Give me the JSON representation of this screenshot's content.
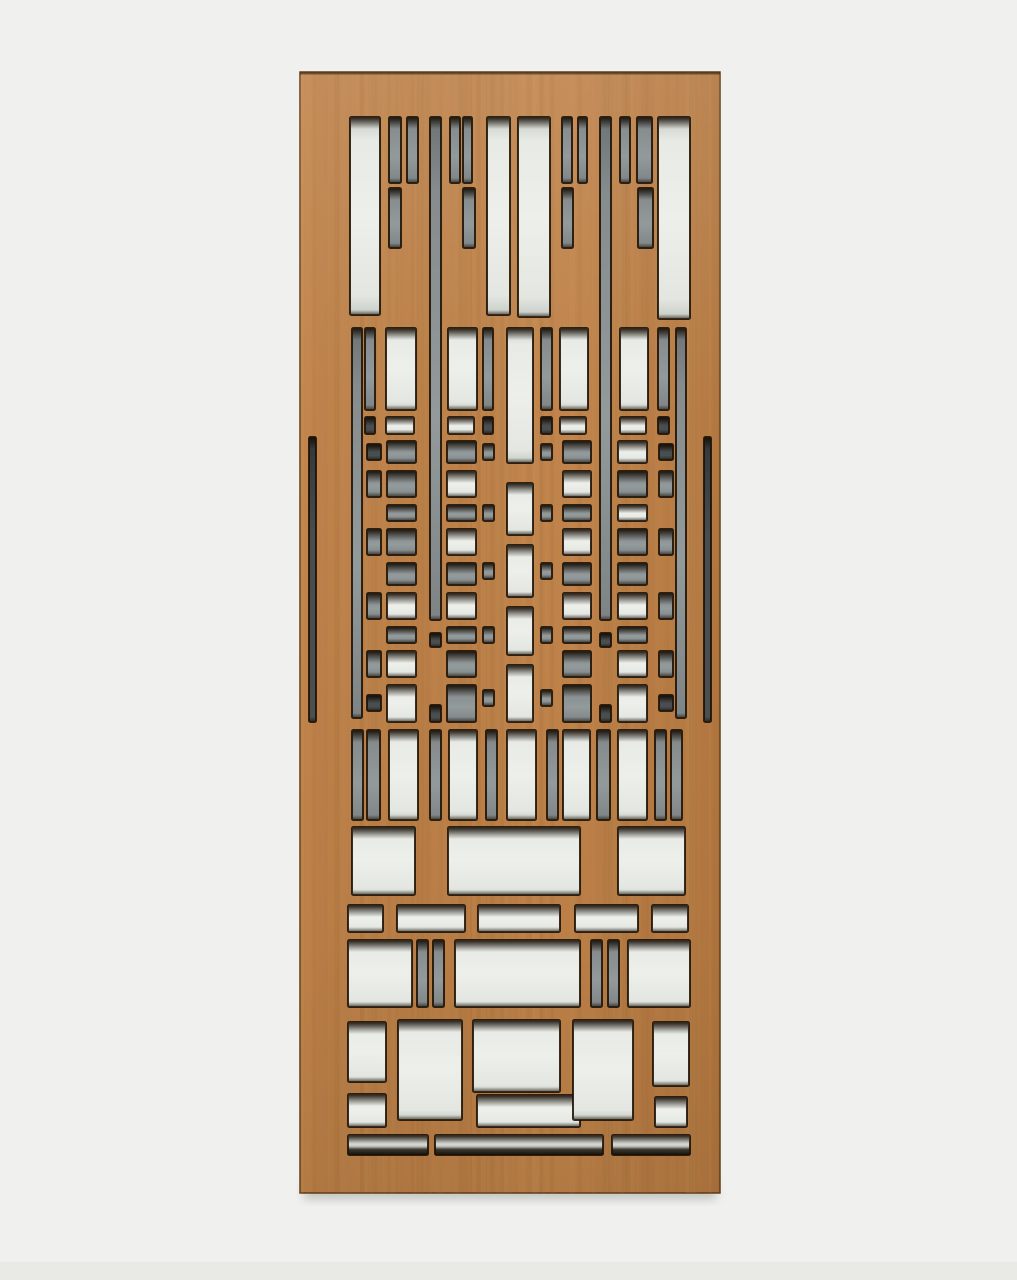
{
  "image": {
    "width": 1017,
    "height": 1280,
    "background": "#f0f1ee",
    "subject": "laser-cut wood fretwork panel, Frank Lloyd Wright style, with frosted backing"
  },
  "panel": {
    "x": 300,
    "y": 72,
    "width": 420,
    "height": 1121,
    "wood_base": "#bc7f46",
    "wood_mid": "#c08349",
    "wood_light": "#d4a168",
    "wood_dark": "#8f5c2d",
    "edge_color": "#5e3c1c",
    "top_edge_color": "#3a2410",
    "drop_shadow": "#9a9a95"
  },
  "cutout_colors": {
    "white": "#edefeb",
    "white_edge": "#c7ccc5",
    "gray": "#939a9b",
    "gray_edge": "#6e7475",
    "dark": "#4a4f50",
    "darker": "#33373a",
    "outline": "#1d1104",
    "inner_shadow": "#140c04",
    "strip_shadow": "#141109"
  },
  "cutouts": [
    [
      350,
      117,
      30,
      198,
      "w"
    ],
    [
      487,
      117,
      23,
      198,
      "w"
    ],
    [
      518,
      117,
      32,
      200,
      "w"
    ],
    [
      658,
      117,
      32,
      202,
      "w"
    ],
    [
      430,
      117,
      11,
      503,
      "g"
    ],
    [
      600,
      117,
      11,
      503,
      "g"
    ],
    [
      389,
      117,
      12,
      66,
      "g"
    ],
    [
      407,
      117,
      11,
      66,
      "g"
    ],
    [
      450,
      117,
      10,
      66,
      "g"
    ],
    [
      463,
      117,
      9,
      66,
      "g"
    ],
    [
      562,
      117,
      10,
      66,
      "g"
    ],
    [
      578,
      117,
      9,
      66,
      "g"
    ],
    [
      620,
      117,
      10,
      66,
      "g"
    ],
    [
      637,
      117,
      15,
      66,
      "g"
    ],
    [
      389,
      188,
      12,
      60,
      "g"
    ],
    [
      463,
      188,
      12,
      60,
      "g"
    ],
    [
      562,
      188,
      11,
      60,
      "g"
    ],
    [
      638,
      188,
      15,
      60,
      "g"
    ],
    [
      352,
      328,
      10,
      390,
      "g"
    ],
    [
      676,
      328,
      10,
      390,
      "g"
    ],
    [
      365,
      328,
      10,
      82,
      "g"
    ],
    [
      483,
      328,
      10,
      82,
      "g"
    ],
    [
      541,
      328,
      11,
      82,
      "g"
    ],
    [
      658,
      328,
      11,
      82,
      "g"
    ],
    [
      386,
      328,
      30,
      82,
      "w"
    ],
    [
      448,
      328,
      29,
      82,
      "w"
    ],
    [
      560,
      328,
      28,
      82,
      "w"
    ],
    [
      620,
      328,
      28,
      82,
      "w"
    ],
    [
      507,
      328,
      26,
      135,
      "w"
    ],
    [
      365,
      417,
      10,
      17,
      "d"
    ],
    [
      386,
      417,
      28,
      17,
      "w"
    ],
    [
      448,
      417,
      26,
      17,
      "w"
    ],
    [
      483,
      417,
      10,
      17,
      "d"
    ],
    [
      541,
      417,
      11,
      17,
      "d"
    ],
    [
      560,
      417,
      26,
      17,
      "w"
    ],
    [
      620,
      417,
      26,
      17,
      "w"
    ],
    [
      658,
      417,
      11,
      17,
      "d"
    ],
    [
      309,
      437,
      7,
      285,
      "d"
    ],
    [
      704,
      437,
      7,
      285,
      "d"
    ],
    [
      507,
      483,
      26,
      52,
      "w"
    ],
    [
      507,
      545,
      26,
      52,
      "w"
    ],
    [
      507,
      607,
      26,
      48,
      "w"
    ],
    [
      507,
      665,
      26,
      57,
      "w"
    ],
    [
      387,
      441,
      29,
      22,
      "g"
    ],
    [
      447,
      441,
      29,
      22,
      "g"
    ],
    [
      563,
      441,
      28,
      22,
      "g"
    ],
    [
      618,
      441,
      29,
      22,
      "w"
    ],
    [
      367,
      444,
      14,
      16,
      "d"
    ],
    [
      483,
      444,
      11,
      16,
      "g"
    ],
    [
      541,
      444,
      11,
      16,
      "g"
    ],
    [
      659,
      444,
      14,
      16,
      "d"
    ],
    [
      367,
      471,
      14,
      26,
      "g"
    ],
    [
      387,
      471,
      29,
      26,
      "g"
    ],
    [
      447,
      471,
      29,
      26,
      "w"
    ],
    [
      563,
      471,
      28,
      26,
      "w"
    ],
    [
      618,
      471,
      29,
      26,
      "g"
    ],
    [
      659,
      471,
      14,
      26,
      "g"
    ],
    [
      387,
      505,
      29,
      16,
      "g"
    ],
    [
      447,
      505,
      29,
      16,
      "g"
    ],
    [
      483,
      505,
      11,
      16,
      "g"
    ],
    [
      541,
      505,
      11,
      16,
      "g"
    ],
    [
      563,
      505,
      28,
      16,
      "g"
    ],
    [
      618,
      505,
      29,
      16,
      "w"
    ],
    [
      367,
      529,
      14,
      26,
      "g"
    ],
    [
      387,
      529,
      29,
      26,
      "g"
    ],
    [
      447,
      529,
      29,
      26,
      "w"
    ],
    [
      563,
      529,
      28,
      26,
      "w"
    ],
    [
      618,
      529,
      29,
      26,
      "g"
    ],
    [
      659,
      529,
      14,
      26,
      "g"
    ],
    [
      387,
      563,
      29,
      22,
      "g"
    ],
    [
      447,
      563,
      29,
      22,
      "g"
    ],
    [
      483,
      563,
      11,
      16,
      "g"
    ],
    [
      541,
      563,
      11,
      16,
      "g"
    ],
    [
      563,
      563,
      28,
      22,
      "g"
    ],
    [
      618,
      563,
      29,
      22,
      "g"
    ],
    [
      367,
      593,
      14,
      26,
      "g"
    ],
    [
      387,
      593,
      29,
      26,
      "w"
    ],
    [
      447,
      593,
      29,
      26,
      "w"
    ],
    [
      563,
      593,
      28,
      26,
      "w"
    ],
    [
      618,
      593,
      29,
      26,
      "w"
    ],
    [
      659,
      593,
      14,
      26,
      "g"
    ],
    [
      387,
      627,
      29,
      16,
      "g"
    ],
    [
      447,
      627,
      29,
      16,
      "g"
    ],
    [
      483,
      627,
      11,
      16,
      "g"
    ],
    [
      541,
      627,
      11,
      16,
      "g"
    ],
    [
      563,
      627,
      28,
      16,
      "g"
    ],
    [
      618,
      627,
      29,
      16,
      "g"
    ],
    [
      430,
      633,
      11,
      14,
      "d"
    ],
    [
      600,
      633,
      11,
      14,
      "d"
    ],
    [
      367,
      651,
      14,
      26,
      "g"
    ],
    [
      387,
      651,
      29,
      26,
      "w"
    ],
    [
      447,
      651,
      29,
      26,
      "g"
    ],
    [
      563,
      651,
      28,
      26,
      "g"
    ],
    [
      618,
      651,
      29,
      26,
      "w"
    ],
    [
      659,
      651,
      14,
      26,
      "g"
    ],
    [
      387,
      685,
      29,
      37,
      "w"
    ],
    [
      447,
      685,
      29,
      37,
      "g"
    ],
    [
      563,
      685,
      28,
      37,
      "g"
    ],
    [
      618,
      685,
      29,
      37,
      "w"
    ],
    [
      483,
      690,
      11,
      16,
      "g"
    ],
    [
      541,
      690,
      11,
      16,
      "g"
    ],
    [
      367,
      695,
      14,
      16,
      "d"
    ],
    [
      659,
      695,
      14,
      16,
      "d"
    ],
    [
      430,
      705,
      11,
      17,
      "d"
    ],
    [
      600,
      705,
      11,
      17,
      "d"
    ],
    [
      352,
      730,
      11,
      90,
      "g"
    ],
    [
      367,
      730,
      13,
      90,
      "g"
    ],
    [
      389,
      730,
      29,
      90,
      "w"
    ],
    [
      430,
      730,
      11,
      90,
      "g"
    ],
    [
      449,
      730,
      28,
      90,
      "w"
    ],
    [
      486,
      730,
      11,
      90,
      "g"
    ],
    [
      507,
      730,
      29,
      90,
      "w"
    ],
    [
      547,
      730,
      11,
      90,
      "g"
    ],
    [
      563,
      730,
      27,
      90,
      "w"
    ],
    [
      597,
      730,
      13,
      90,
      "g"
    ],
    [
      618,
      730,
      29,
      90,
      "w"
    ],
    [
      655,
      730,
      11,
      90,
      "g"
    ],
    [
      671,
      730,
      11,
      90,
      "g"
    ],
    [
      352,
      827,
      63,
      68,
      "w"
    ],
    [
      448,
      827,
      132,
      68,
      "w"
    ],
    [
      618,
      827,
      67,
      68,
      "w"
    ],
    [
      348,
      905,
      35,
      27,
      "w"
    ],
    [
      397,
      905,
      68,
      27,
      "w"
    ],
    [
      478,
      905,
      82,
      27,
      "w"
    ],
    [
      575,
      905,
      63,
      27,
      "w"
    ],
    [
      652,
      905,
      36,
      27,
      "w"
    ],
    [
      348,
      940,
      64,
      67,
      "w"
    ],
    [
      417,
      940,
      11,
      67,
      "g"
    ],
    [
      433,
      940,
      11,
      67,
      "g"
    ],
    [
      455,
      940,
      125,
      67,
      "w"
    ],
    [
      591,
      940,
      11,
      67,
      "g"
    ],
    [
      608,
      940,
      11,
      67,
      "g"
    ],
    [
      628,
      940,
      62,
      67,
      "w"
    ],
    [
      348,
      1022,
      38,
      60,
      "w"
    ],
    [
      348,
      1094,
      38,
      33,
      "w"
    ],
    [
      398,
      1020,
      64,
      100,
      "w"
    ],
    [
      473,
      1020,
      87,
      72,
      "w"
    ],
    [
      477,
      1095,
      103,
      32,
      "w"
    ],
    [
      573,
      1020,
      60,
      100,
      "w"
    ],
    [
      653,
      1022,
      36,
      64,
      "w"
    ],
    [
      655,
      1097,
      32,
      30,
      "w"
    ],
    [
      348,
      1135,
      80,
      20,
      "ws"
    ],
    [
      435,
      1135,
      168,
      20,
      "ws"
    ],
    [
      612,
      1135,
      78,
      20,
      "ws"
    ]
  ]
}
